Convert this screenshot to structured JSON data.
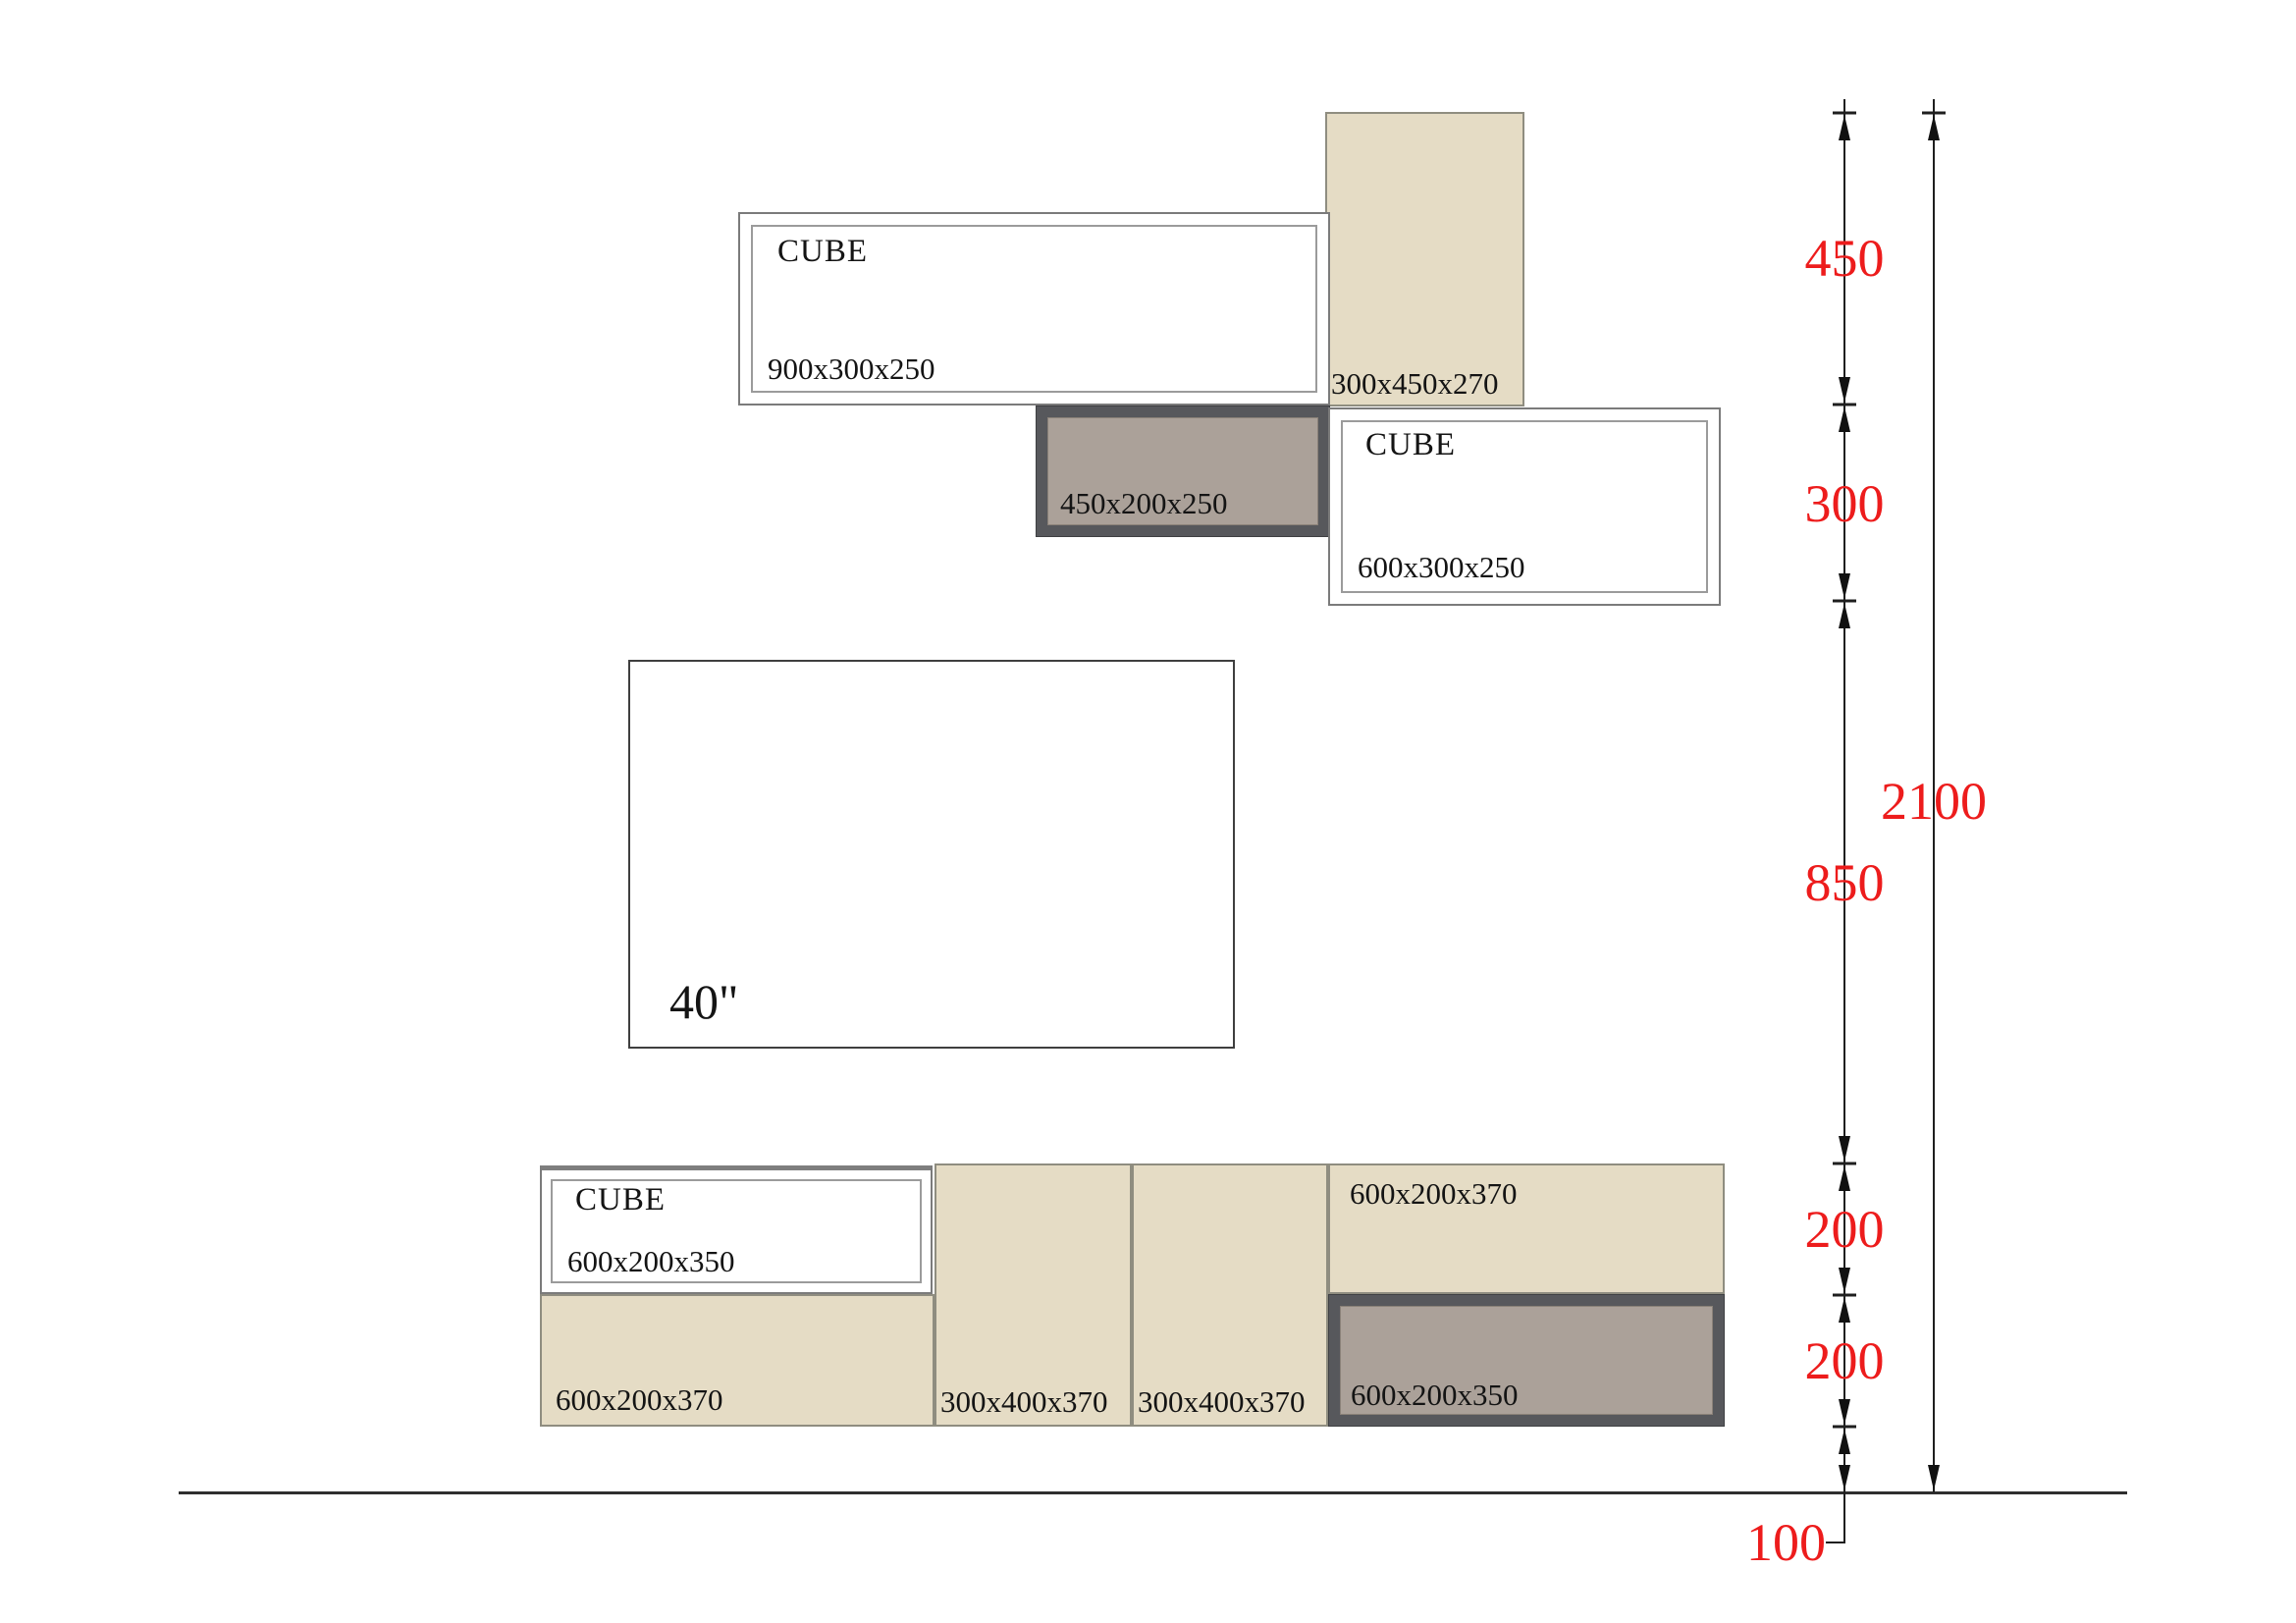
{
  "drawing_title": "wall-unit elevation with cube shelves, TV and stacked base cabinets",
  "colors": {
    "background": "#ffffff",
    "beige_fill": "#e5dcc5",
    "mauve_fill": "#aba199",
    "dark_frame": "#57585c",
    "dimension_red": "#ed1c1c",
    "line_black": "#1f1f1f"
  },
  "cabinets": {
    "cube_top": {
      "label": "CUBE",
      "size": "900x300x250"
    },
    "shelf_tall": {
      "size": "300x450x270"
    },
    "shelf_gray": {
      "size": "450x200x250"
    },
    "cube_right": {
      "label": "CUBE",
      "size": "600x300x250"
    },
    "tv": {
      "label": "40\""
    },
    "cube_bottom": {
      "label": "CUBE",
      "size": "600x200x350"
    },
    "base_left": {
      "size": "600x200x370"
    },
    "base_col1": {
      "size": "300x400x370"
    },
    "base_col2": {
      "size": "300x400x370"
    },
    "base_right_top": {
      "size": "600x200x370"
    },
    "base_right_bottom": {
      "size": "600x200x350"
    }
  },
  "dimensions": {
    "d450": "450",
    "d300": "300",
    "d850": "850",
    "d2100": "2100",
    "d200a": "200",
    "d200b": "200",
    "d100": "100"
  }
}
